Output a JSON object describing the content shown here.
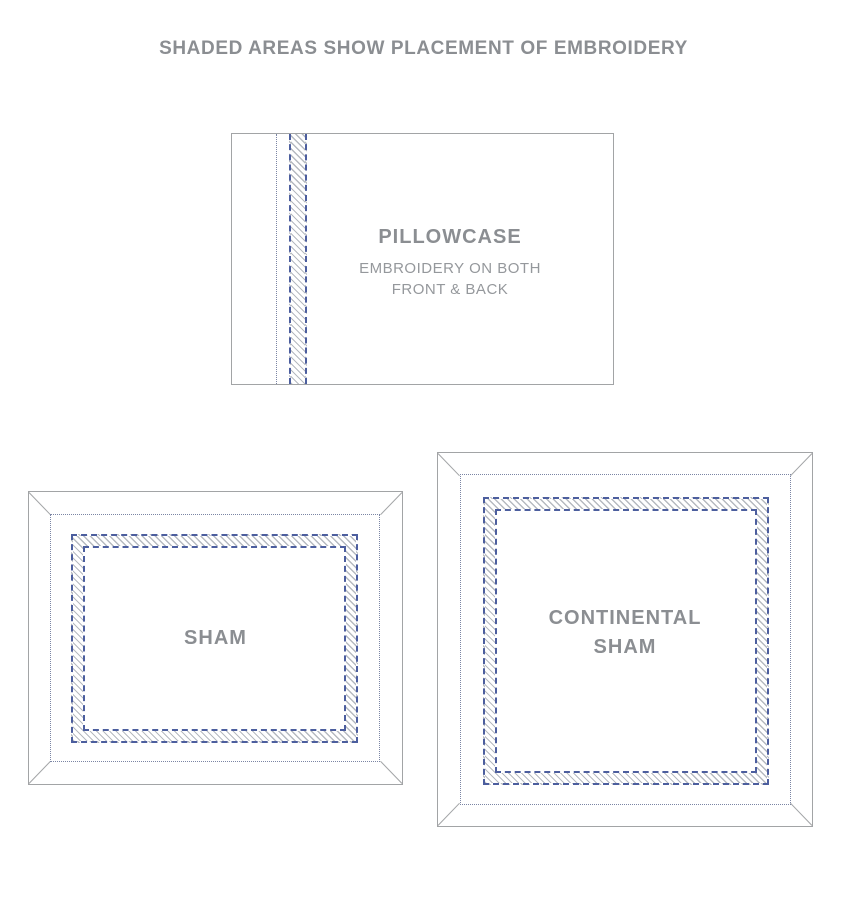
{
  "title": "SHADED AREAS SHOW PLACEMENT OF EMBROIDERY",
  "colors": {
    "dash_blue": "#4c5e9e",
    "dot_blue": "#7b85a4",
    "hatch_gray": "#b6bac0",
    "line_gray": "#a2a4a6",
    "text_gray": "#8b8e92",
    "subtext_gray": "#95989c",
    "bg": "#ffffff"
  },
  "pillowcase": {
    "label": "PILLOWCASE",
    "sublabel_line1": "EMBROIDERY ON BOTH",
    "sublabel_line2": "FRONT & BACK"
  },
  "sham": {
    "label": "SHAM"
  },
  "continental_sham": {
    "label_line1": "CONTINENTAL",
    "label_line2": "SHAM"
  }
}
